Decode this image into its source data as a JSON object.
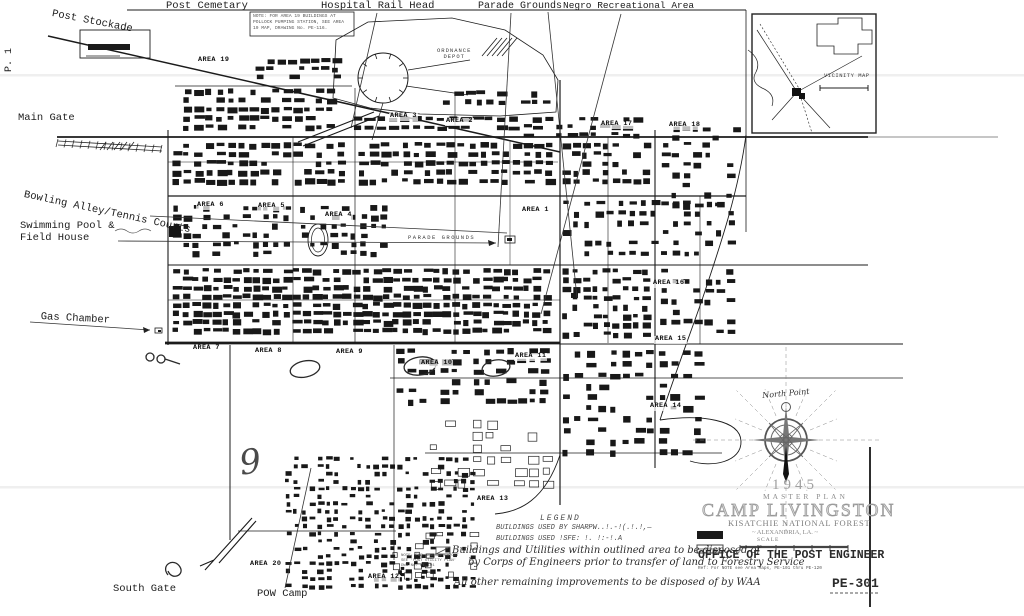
{
  "canvas": {
    "width": 1024,
    "height": 616,
    "paper": "#ffffff",
    "ink": "#1b1b1b",
    "gray": "#8a8a8a",
    "faint": "#efefef"
  },
  "labels": {
    "edge": [
      {
        "id": "label-post-stockade",
        "text": "Post Stockade",
        "x": 53,
        "y": 9,
        "fs": 10.5,
        "rot": 11,
        "cls": "mono"
      },
      {
        "id": "label-post-cemetary",
        "text": "Post Cemetary",
        "x": 166,
        "y": 1,
        "fs": 10.5,
        "cls": "mono"
      },
      {
        "id": "label-hospital-rail-head",
        "text": "Hospital Rail Head",
        "x": 321,
        "y": 1,
        "fs": 10.5,
        "cls": "mono"
      },
      {
        "id": "label-parade-grounds",
        "text": "Parade Grounds",
        "x": 478,
        "y": 1,
        "fs": 10,
        "cls": "mono"
      },
      {
        "id": "label-negro-recreational-area",
        "text": "Negro Recreational Area",
        "x": 563,
        "y": 1,
        "fs": 9.5,
        "cls": "mono"
      },
      {
        "id": "label-main-gate",
        "text": "Main Gate",
        "x": 18,
        "y": 113,
        "fs": 10.5,
        "cls": "mono"
      },
      {
        "id": "label-bowling-alley-tennis-courts",
        "text": "Bowling Alley/Tennis Courts",
        "x": 25,
        "y": 190,
        "fs": 10.5,
        "rot": 12,
        "cls": "mono"
      },
      {
        "id": "label-swimming-pool",
        "text": "Swimming Pool &",
        "x": 20,
        "y": 221,
        "fs": 10.5,
        "cls": "mono"
      },
      {
        "id": "label-field-house",
        "text": "Field House",
        "x": 20,
        "y": 233,
        "fs": 10.5,
        "cls": "mono"
      },
      {
        "id": "label-gas-chamber",
        "text": "Gas Chamber",
        "x": 41,
        "y": 312,
        "fs": 10.5,
        "rot": 3,
        "cls": "mono"
      },
      {
        "id": "label-south-gate",
        "text": "South Gate",
        "x": 113,
        "y": 584,
        "fs": 10.5,
        "cls": "mono"
      },
      {
        "id": "label-pow-camp",
        "text": "POW Camp",
        "x": 257,
        "y": 589,
        "fs": 10.5,
        "cls": "mono"
      }
    ],
    "areas": [
      {
        "id": "area-19",
        "text": "AREA 19",
        "x": 197,
        "y": 57,
        "fs": 6.8,
        "cls": "area"
      },
      {
        "id": "area-3",
        "text": "AREA 3",
        "x": 389,
        "y": 113,
        "fs": 6.8,
        "cls": "area"
      },
      {
        "id": "area-2",
        "text": "AREA 2",
        "x": 445,
        "y": 118,
        "fs": 6.8,
        "cls": "area"
      },
      {
        "id": "area-17",
        "text": "AREA 17",
        "x": 600,
        "y": 121,
        "fs": 6.8,
        "cls": "area"
      },
      {
        "id": "area-18",
        "text": "AREA 18",
        "x": 668,
        "y": 122,
        "fs": 6.8,
        "cls": "area"
      },
      {
        "id": "area-6",
        "text": "AREA 6",
        "x": 196,
        "y": 202,
        "fs": 6.8,
        "cls": "area"
      },
      {
        "id": "area-5",
        "text": "AREA 5",
        "x": 257,
        "y": 203,
        "fs": 6.8,
        "cls": "area"
      },
      {
        "id": "area-4",
        "text": "AREA 4",
        "x": 324,
        "y": 212,
        "fs": 6.8,
        "cls": "area"
      },
      {
        "id": "area-1",
        "text": "AREA 1",
        "x": 521,
        "y": 207,
        "fs": 6.8,
        "cls": "area"
      },
      {
        "id": "area-16",
        "text": "AREA 16",
        "x": 652,
        "y": 280,
        "fs": 6.8,
        "cls": "area"
      },
      {
        "id": "area-15",
        "text": "AREA 15",
        "x": 654,
        "y": 336,
        "fs": 6.8,
        "cls": "area"
      },
      {
        "id": "area-7",
        "text": "AREA 7",
        "x": 192,
        "y": 345,
        "fs": 6.8,
        "cls": "area"
      },
      {
        "id": "area-8",
        "text": "AREA 8",
        "x": 254,
        "y": 348,
        "fs": 6.8,
        "cls": "area"
      },
      {
        "id": "area-9",
        "text": "AREA 9",
        "x": 335,
        "y": 349,
        "fs": 6.8,
        "cls": "area"
      },
      {
        "id": "area-10",
        "text": "AREA 10",
        "x": 420,
        "y": 360,
        "fs": 6.8,
        "cls": "area"
      },
      {
        "id": "area-11",
        "text": "AREA 11",
        "x": 514,
        "y": 353,
        "fs": 6.8,
        "cls": "area"
      },
      {
        "id": "area-14",
        "text": "AREA 14",
        "x": 649,
        "y": 403,
        "fs": 6.8,
        "cls": "area"
      },
      {
        "id": "area-13",
        "text": "AREA 13",
        "x": 476,
        "y": 496,
        "fs": 6.8,
        "cls": "area"
      },
      {
        "id": "area-20",
        "text": "AREA 20",
        "x": 249,
        "y": 561,
        "fs": 6.8,
        "cls": "area"
      },
      {
        "id": "area-12",
        "text": "AREA 12",
        "x": 367,
        "y": 574,
        "fs": 6.8,
        "cls": "area"
      }
    ],
    "features": [
      {
        "id": "label-ordnance-depot",
        "text": "ORDNANCE\nDEPOT",
        "x": 437,
        "y": 48,
        "fs": 5.5,
        "cls": "feature",
        "ls": 1
      },
      {
        "id": "label-parade-grounds-field",
        "text": "PARADE GROUNDS",
        "x": 408,
        "y": 235,
        "fs": 5.5,
        "cls": "feature",
        "ls": 1.5
      },
      {
        "id": "label-vicinity-map",
        "text": "VICINITY MAP",
        "x": 824,
        "y": 73,
        "fs": 5.5,
        "cls": "feature",
        "ls": 0.5
      }
    ],
    "notes": [
      {
        "id": "note-area19",
        "text": "NOTE: FOR AREA 19 BUILDINGS AT POLLOCK PUMPING STATION, SEE AREA 19 MAP, DRAWING No. PE-116.",
        "x": 253,
        "y": 14,
        "fs": 4.6,
        "w": 99,
        "cls": "tiny"
      },
      {
        "id": "note-legend-side",
        "text": "NOTE: FOR GENERAL LAYOUT SEE 'POST UTILITY PLAN' DWG No. PE-101",
        "x": 401,
        "y": 554,
        "fs": 4,
        "w": 60,
        "cls": "tiny"
      },
      {
        "id": "note-office-ref",
        "text": "Ref: For NOTE see Area Maps, PE-101 thru PE-120",
        "x": 698,
        "y": 566,
        "fs": 4.4,
        "w": 190,
        "cls": "tiny"
      }
    ],
    "legend": [
      {
        "id": "legend-heading",
        "text": "LEGEND",
        "x": 540,
        "y": 515,
        "fs": 8,
        "ls": 2,
        "cls": "legend-type"
      },
      {
        "id": "legend-row-1",
        "text": "BUILDINGS USED BY SHARPW..!.-!(.!.!,—",
        "x": 496,
        "y": 525,
        "fs": 7,
        "cls": "legend-type"
      },
      {
        "id": "legend-row-2",
        "text": "BUILDINGS USED !SFE: !. !:-!.A",
        "x": 496,
        "y": 536,
        "fs": 7,
        "cls": "legend-type"
      },
      {
        "id": "legend-hand-1",
        "text": "Buildings and Utilities within outlined area to be disposed of",
        "x": 452,
        "y": 545,
        "fs": 10,
        "cls": "hand"
      },
      {
        "id": "legend-hand-2",
        "text": "by Corps of Engineers prior to transfer of land to Forestry Service",
        "x": 468,
        "y": 557,
        "fs": 10,
        "cls": "hand"
      },
      {
        "id": "legend-hand-3",
        "text": "All other remaining improvements to be disposed of by WAA",
        "x": 454,
        "y": 577,
        "fs": 10,
        "cls": "hand"
      }
    ],
    "title_block": [
      {
        "id": "title-year",
        "text": "1945",
        "x": 772,
        "y": 477,
        "fs": 15,
        "ls": 4,
        "cls": "title",
        "color": "#a0a0a0"
      },
      {
        "id": "title-master-plan",
        "text": "MASTER PLAN",
        "x": 763,
        "y": 493,
        "fs": 7.5,
        "ls": 3,
        "cls": "title",
        "color": "#8e8e8e"
      },
      {
        "id": "title-camp-livingston",
        "text": "CAMP LIVINGSTON",
        "x": 702,
        "y": 500,
        "fs": 18,
        "ls": 2,
        "cls": "outline"
      },
      {
        "id": "title-kisatchie",
        "text": "KISATCHIE NATIONAL FOREST",
        "x": 728,
        "y": 519,
        "fs": 8.5,
        "ls": 0.8,
        "cls": "title",
        "color": "#7e7e7e"
      },
      {
        "id": "title-alexandria",
        "text": "~ ALEXANDRIA, LA. ~",
        "x": 752,
        "y": 529,
        "fs": 6.5,
        "cls": "title",
        "color": "#8a8a8a"
      },
      {
        "id": "title-scale",
        "text": "SCALE",
        "x": 757,
        "y": 537,
        "fs": 5.5,
        "ls": 1,
        "cls": "title",
        "color": "#777777"
      },
      {
        "id": "title-office",
        "text": "OFFICE OF THE POST ENGINEER",
        "x": 698,
        "y": 550,
        "fs": 11.5,
        "cls": "office"
      },
      {
        "id": "title-drawing-number",
        "text": "PE-301",
        "x": 832,
        "y": 577,
        "fs": 13,
        "cls": "office"
      }
    ],
    "annotations": [
      {
        "id": "page-marker",
        "text": "P. 1",
        "x": 4,
        "y": 72,
        "fs": 10,
        "rot": -90,
        "cls": "mono"
      },
      {
        "id": "hand-nine",
        "text": "9",
        "x": 237,
        "y": 445,
        "fs": 34,
        "rot": -8,
        "cls": "hand",
        "color": "#4a4a4a"
      },
      {
        "id": "hand-north-point",
        "text": "North Point",
        "x": 762,
        "y": 392,
        "fs": 8,
        "rot": -5,
        "cls": "hand",
        "color": "#333333"
      }
    ]
  }
}
